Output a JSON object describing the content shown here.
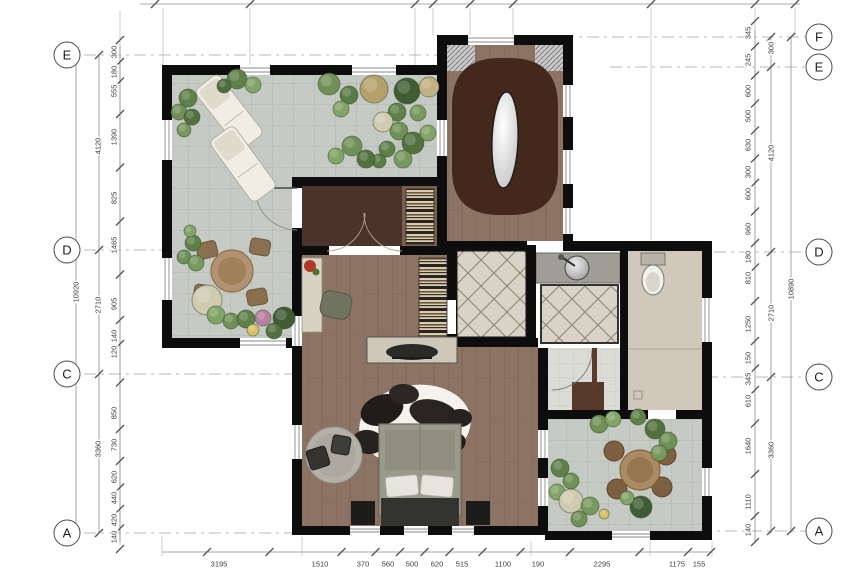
{
  "grid": {
    "left_bubbles": [
      {
        "label": "E",
        "x": 67,
        "y": 55
      },
      {
        "label": "D",
        "x": 67,
        "y": 250
      },
      {
        "label": "C",
        "x": 67,
        "y": 374
      },
      {
        "label": "A",
        "x": 67,
        "y": 533
      }
    ],
    "right_bubbles": [
      {
        "label": "F",
        "x": 819,
        "y": 37
      },
      {
        "label": "E",
        "x": 819,
        "y": 67
      },
      {
        "label": "D",
        "x": 819,
        "y": 252
      },
      {
        "label": "C",
        "x": 819,
        "y": 377
      },
      {
        "label": "A",
        "x": 819,
        "y": 531
      }
    ]
  },
  "dimensions": {
    "right_inner": [
      {
        "t": "345",
        "y": 33
      },
      {
        "t": "245",
        "y": 60
      },
      {
        "t": "600",
        "y": 91
      },
      {
        "t": "500",
        "y": 116
      },
      {
        "t": "630",
        "y": 145
      },
      {
        "t": "300",
        "y": 172
      },
      {
        "t": "600",
        "y": 194
      },
      {
        "t": "960",
        "y": 229
      },
      {
        "t": "180",
        "y": 257
      },
      {
        "t": "810",
        "y": 278
      },
      {
        "t": "1250",
        "y": 324
      },
      {
        "t": "150",
        "y": 358
      },
      {
        "t": "345",
        "y": 379
      },
      {
        "t": "610",
        "y": 401
      },
      {
        "t": "1640",
        "y": 446
      },
      {
        "t": "1110",
        "y": 502
      },
      {
        "t": "140",
        "y": 530
      }
    ],
    "right_totals": [
      {
        "t": "300",
        "y": 48
      },
      {
        "t": "4120",
        "y": 153
      },
      {
        "t": "2710",
        "y": 313
      },
      {
        "t": "3360",
        "y": 450
      }
    ],
    "right_overall": [
      {
        "t": "10890",
        "x": 791,
        "y": 289
      }
    ],
    "left_inner": [
      {
        "t": "300",
        "y": 52
      },
      {
        "t": "180",
        "y": 72
      },
      {
        "t": "555",
        "y": 91
      },
      {
        "t": "1390",
        "y": 137
      },
      {
        "t": "825",
        "y": 198
      },
      {
        "t": "1465",
        "y": 245
      },
      {
        "t": "905",
        "y": 304
      },
      {
        "t": "140",
        "y": 336
      },
      {
        "t": "120",
        "y": 352
      },
      {
        "t": "850",
        "y": 413
      },
      {
        "t": "730",
        "y": 445
      },
      {
        "t": "620",
        "y": 477
      },
      {
        "t": "440",
        "y": 498
      },
      {
        "t": "420",
        "y": 520
      },
      {
        "t": "140",
        "y": 537
      }
    ],
    "left_totals": [
      {
        "t": "4120",
        "y": 146
      },
      {
        "t": "2710",
        "y": 305
      },
      {
        "t": "3360",
        "y": 449
      }
    ],
    "left_overall": [
      {
        "t": "10920",
        "x": 76,
        "y": 292
      }
    ],
    "bottom": [
      {
        "t": "3195",
        "x": 219
      },
      {
        "t": "1510",
        "x": 320
      },
      {
        "t": "370",
        "x": 363
      },
      {
        "t": "560",
        "x": 388
      },
      {
        "t": "500",
        "x": 412
      },
      {
        "t": "620",
        "x": 437
      },
      {
        "t": "515",
        "x": 462
      },
      {
        "t": "1100",
        "x": 503
      },
      {
        "t": "190",
        "x": 538
      },
      {
        "t": "2295",
        "x": 602
      },
      {
        "t": "1175",
        "x": 677
      },
      {
        "t": "155",
        "x": 699
      }
    ]
  },
  "colors": {
    "wall": "#0d0d0d",
    "terrace_tile": "#c6cac5",
    "tile_line": "#b0b5b0",
    "wood_floor": "#8d7363",
    "wood_line": "#7b6254",
    "stair_dark_wood": "#45281c",
    "vestibule_mat": "#4a332a",
    "vestibule_wood": "#7b5f4c",
    "beige_floor": "#cfc8bb",
    "foyer_tile": "#d8d3c6",
    "diamond_line": "#847b6f",
    "counter_gray": "#a09e96",
    "bed_gray": "#9a9a8c",
    "bed_dark": "#33332f",
    "rug_gray": "#b5b0a8",
    "lounger_white": "#f0ede5",
    "table_tan": "#b29270"
  },
  "plants": [
    [
      188,
      98,
      9,
      "#5e8049"
    ],
    [
      179,
      112,
      8,
      "#6f9157"
    ],
    [
      192,
      117,
      8,
      "#52713f"
    ],
    [
      184,
      130,
      7,
      "#77995f"
    ],
    [
      237,
      79,
      10,
      "#5e8049"
    ],
    [
      253,
      85,
      8,
      "#83a468"
    ],
    [
      224,
      86,
      7,
      "#4f6e3e"
    ],
    [
      329,
      84,
      11,
      "#6f9157"
    ],
    [
      349,
      95,
      9,
      "#597b45"
    ],
    [
      341,
      109,
      8,
      "#83a468"
    ],
    [
      374,
      89,
      14,
      "#b3a06b"
    ],
    [
      407,
      91,
      13,
      "#3f5c33"
    ],
    [
      429,
      87,
      10,
      "#c2b183"
    ],
    [
      397,
      112,
      9,
      "#5e8049"
    ],
    [
      418,
      113,
      8,
      "#77995f"
    ],
    [
      383,
      122,
      10,
      "#cfcab0"
    ],
    [
      399,
      131,
      9,
      "#6f9157"
    ],
    [
      413,
      143,
      11,
      "#52713f"
    ],
    [
      428,
      133,
      8,
      "#83a468"
    ],
    [
      387,
      149,
      8,
      "#5e8049"
    ],
    [
      403,
      159,
      9,
      "#77995f"
    ],
    [
      379,
      161,
      7,
      "#597b45"
    ],
    [
      352,
      146,
      10,
      "#6f9157"
    ],
    [
      336,
      156,
      8,
      "#83a468"
    ],
    [
      366,
      159,
      9,
      "#52713f"
    ],
    [
      193,
      243,
      8,
      "#5e8049"
    ],
    [
      184,
      257,
      7,
      "#6f9157"
    ],
    [
      196,
      263,
      8,
      "#77995f"
    ],
    [
      190,
      231,
      6,
      "#83a468"
    ],
    [
      207,
      300,
      15,
      "#cfcab0"
    ],
    [
      216,
      315,
      9,
      "#83a468"
    ],
    [
      231,
      321,
      8,
      "#6f9157"
    ],
    [
      246,
      319,
      9,
      "#5e8049"
    ],
    [
      263,
      318,
      8,
      "#b87fa3"
    ],
    [
      284,
      318,
      11,
      "#3f5c33"
    ],
    [
      274,
      331,
      8,
      "#52713f"
    ],
    [
      253,
      330,
      6,
      "#d8c06a"
    ],
    [
      599,
      424,
      9,
      "#6f9157"
    ],
    [
      613,
      419,
      8,
      "#83a468"
    ],
    [
      638,
      417,
      8,
      "#5e8049"
    ],
    [
      655,
      429,
      10,
      "#52713f"
    ],
    [
      668,
      441,
      9,
      "#6f9157"
    ],
    [
      659,
      453,
      8,
      "#77995f"
    ],
    [
      560,
      468,
      9,
      "#5e8049"
    ],
    [
      571,
      481,
      8,
      "#6f9157"
    ],
    [
      557,
      492,
      8,
      "#83a468"
    ],
    [
      571,
      501,
      12,
      "#cfcab0"
    ],
    [
      590,
      506,
      9,
      "#77995f"
    ],
    [
      641,
      507,
      11,
      "#3f5c33"
    ],
    [
      604,
      514,
      5,
      "#d8c06a"
    ],
    [
      579,
      519,
      8,
      "#6f9157"
    ],
    [
      627,
      498,
      7,
      "#83a468"
    ]
  ]
}
